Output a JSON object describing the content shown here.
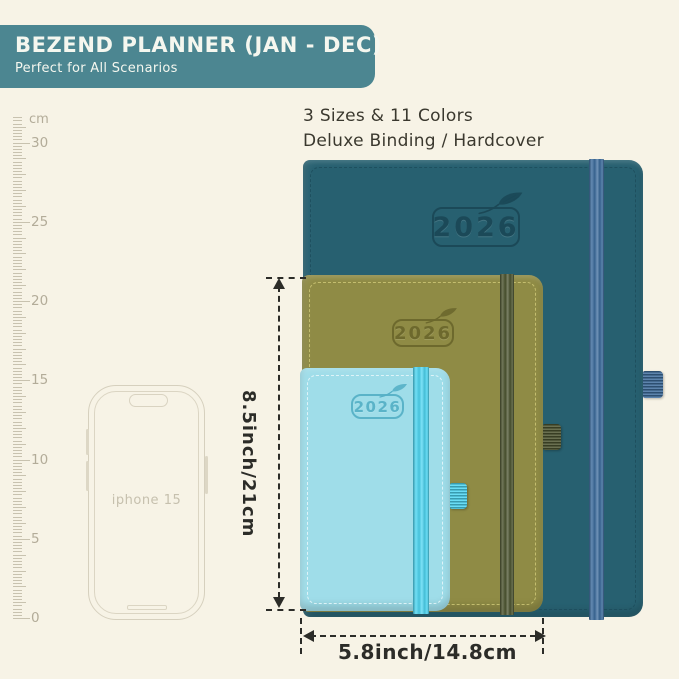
{
  "background_color": "#f7f3e6",
  "header": {
    "title": "BEZEND PLANNER (JAN - DEC)",
    "subtitle": "Perfect for All Scenarios",
    "bg_color": "#4c8691",
    "text_color": "#f5f7ef"
  },
  "info": {
    "line1": "3 Sizes & 11 Colors",
    "line2": "Deluxe Binding / Hardcover"
  },
  "ruler": {
    "unit_label": "cm",
    "tick_numbers": [
      30,
      25,
      20,
      15,
      10,
      5,
      0
    ]
  },
  "phone": {
    "label": "iphone 15"
  },
  "planners": [
    {
      "id": "large-teal",
      "year": "2026",
      "cover": "#276070",
      "stitch": "#1d4d5c",
      "band": "#3d6d9e",
      "loop": "#3e6d9d",
      "emboss": "#1b4856"
    },
    {
      "id": "medium-olive",
      "year": "2026",
      "cover": "#8f8b45",
      "stitch": "#cdc676",
      "band": "#4d5530",
      "loop": "#4d5530",
      "emboss": "#6b672c"
    },
    {
      "id": "small-blue",
      "year": "2026",
      "cover": "#9fdde9",
      "stitch": "#e9f8fb",
      "band": "#4ed7f3",
      "loop": "#4ed7f3",
      "emboss": "#55b0c6"
    }
  ],
  "dimensions": {
    "height_label": "8.5inch/21cm",
    "width_label": "5.8inch/14.8cm",
    "line_color": "#2c2c28"
  }
}
